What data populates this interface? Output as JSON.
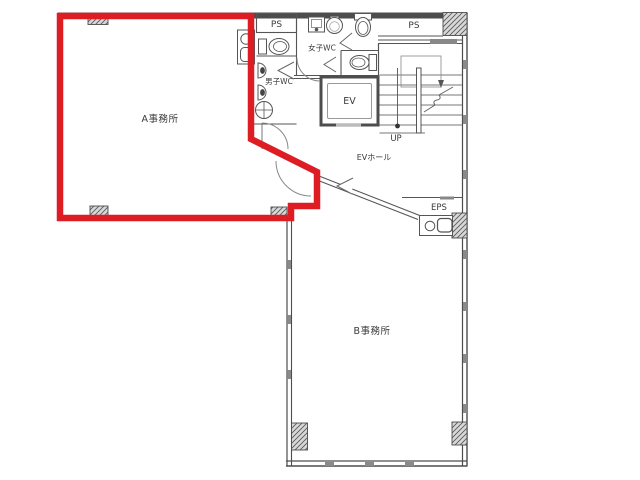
{
  "plan": {
    "colors": {
      "highlight_red": "#dd1c24",
      "wall_dark": "#4d4d4d",
      "line_gray": "#666666",
      "text": "#3a3a3a"
    },
    "rooms": {
      "office_a": "A事務所",
      "office_b": "B事務所",
      "ev": "EV",
      "ev_hall": "EVホール",
      "womens_wc": "女子WC",
      "mens_wc": "男子WC",
      "ps_left": "PS",
      "ps_right": "PS",
      "eps": "EPS",
      "stair_direction": "UP"
    }
  }
}
